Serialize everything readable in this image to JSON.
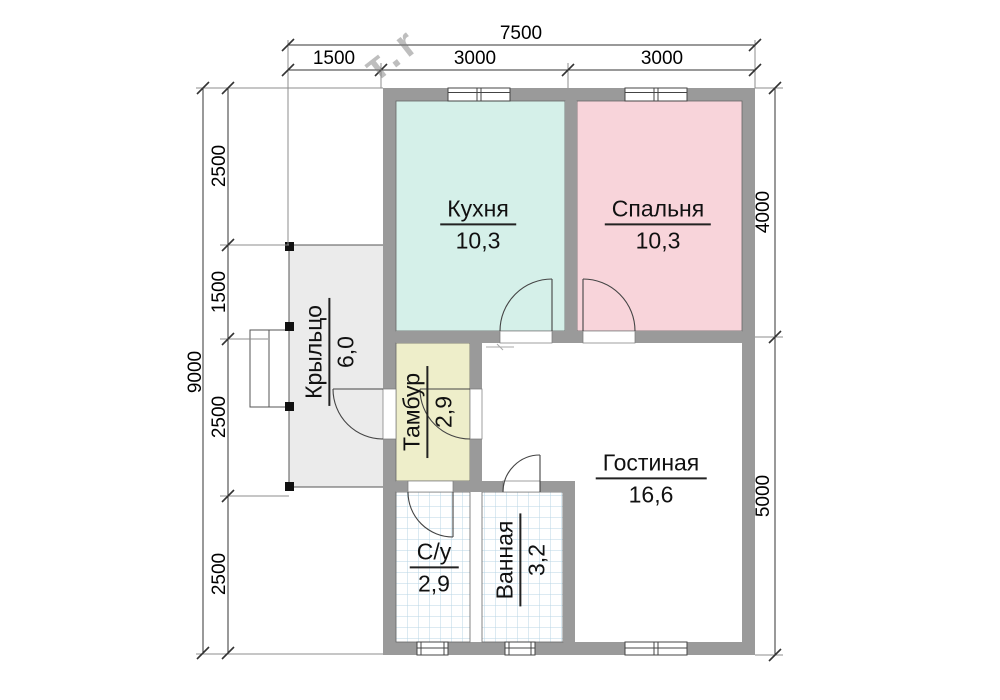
{
  "rooms": {
    "kitchen": {
      "name": "Кухня",
      "area": "10,3"
    },
    "bedroom": {
      "name": "Спальня",
      "area": "10,3"
    },
    "living": {
      "name": "Гостиная",
      "area": "16,6"
    },
    "vestibule": {
      "name": "Тамбур",
      "area": "2,9"
    },
    "porch": {
      "name": "Крыльцо",
      "area": "6,0"
    },
    "wc": {
      "name": "С/у",
      "area": "2,9"
    },
    "bathroom": {
      "name": "Ванная",
      "area": "3,2"
    }
  },
  "dimensions": {
    "top": {
      "total": "7500",
      "segments": [
        "1500",
        "3000",
        "3000"
      ]
    },
    "left": {
      "total": "9000",
      "segments": [
        "2500",
        "1500",
        "2500",
        "2500"
      ]
    },
    "right": {
      "segments": [
        "4000",
        "5000"
      ]
    }
  },
  "watermark": "т.r",
  "colors": {
    "wall": "#9a9a9a",
    "kitchen": "#d5f0e9",
    "bedroom": "#f8d4da",
    "vestibule": "#eeeeca",
    "porch": "#ebebeb",
    "tile_line": "#b9d6e4",
    "line": "#444444"
  }
}
